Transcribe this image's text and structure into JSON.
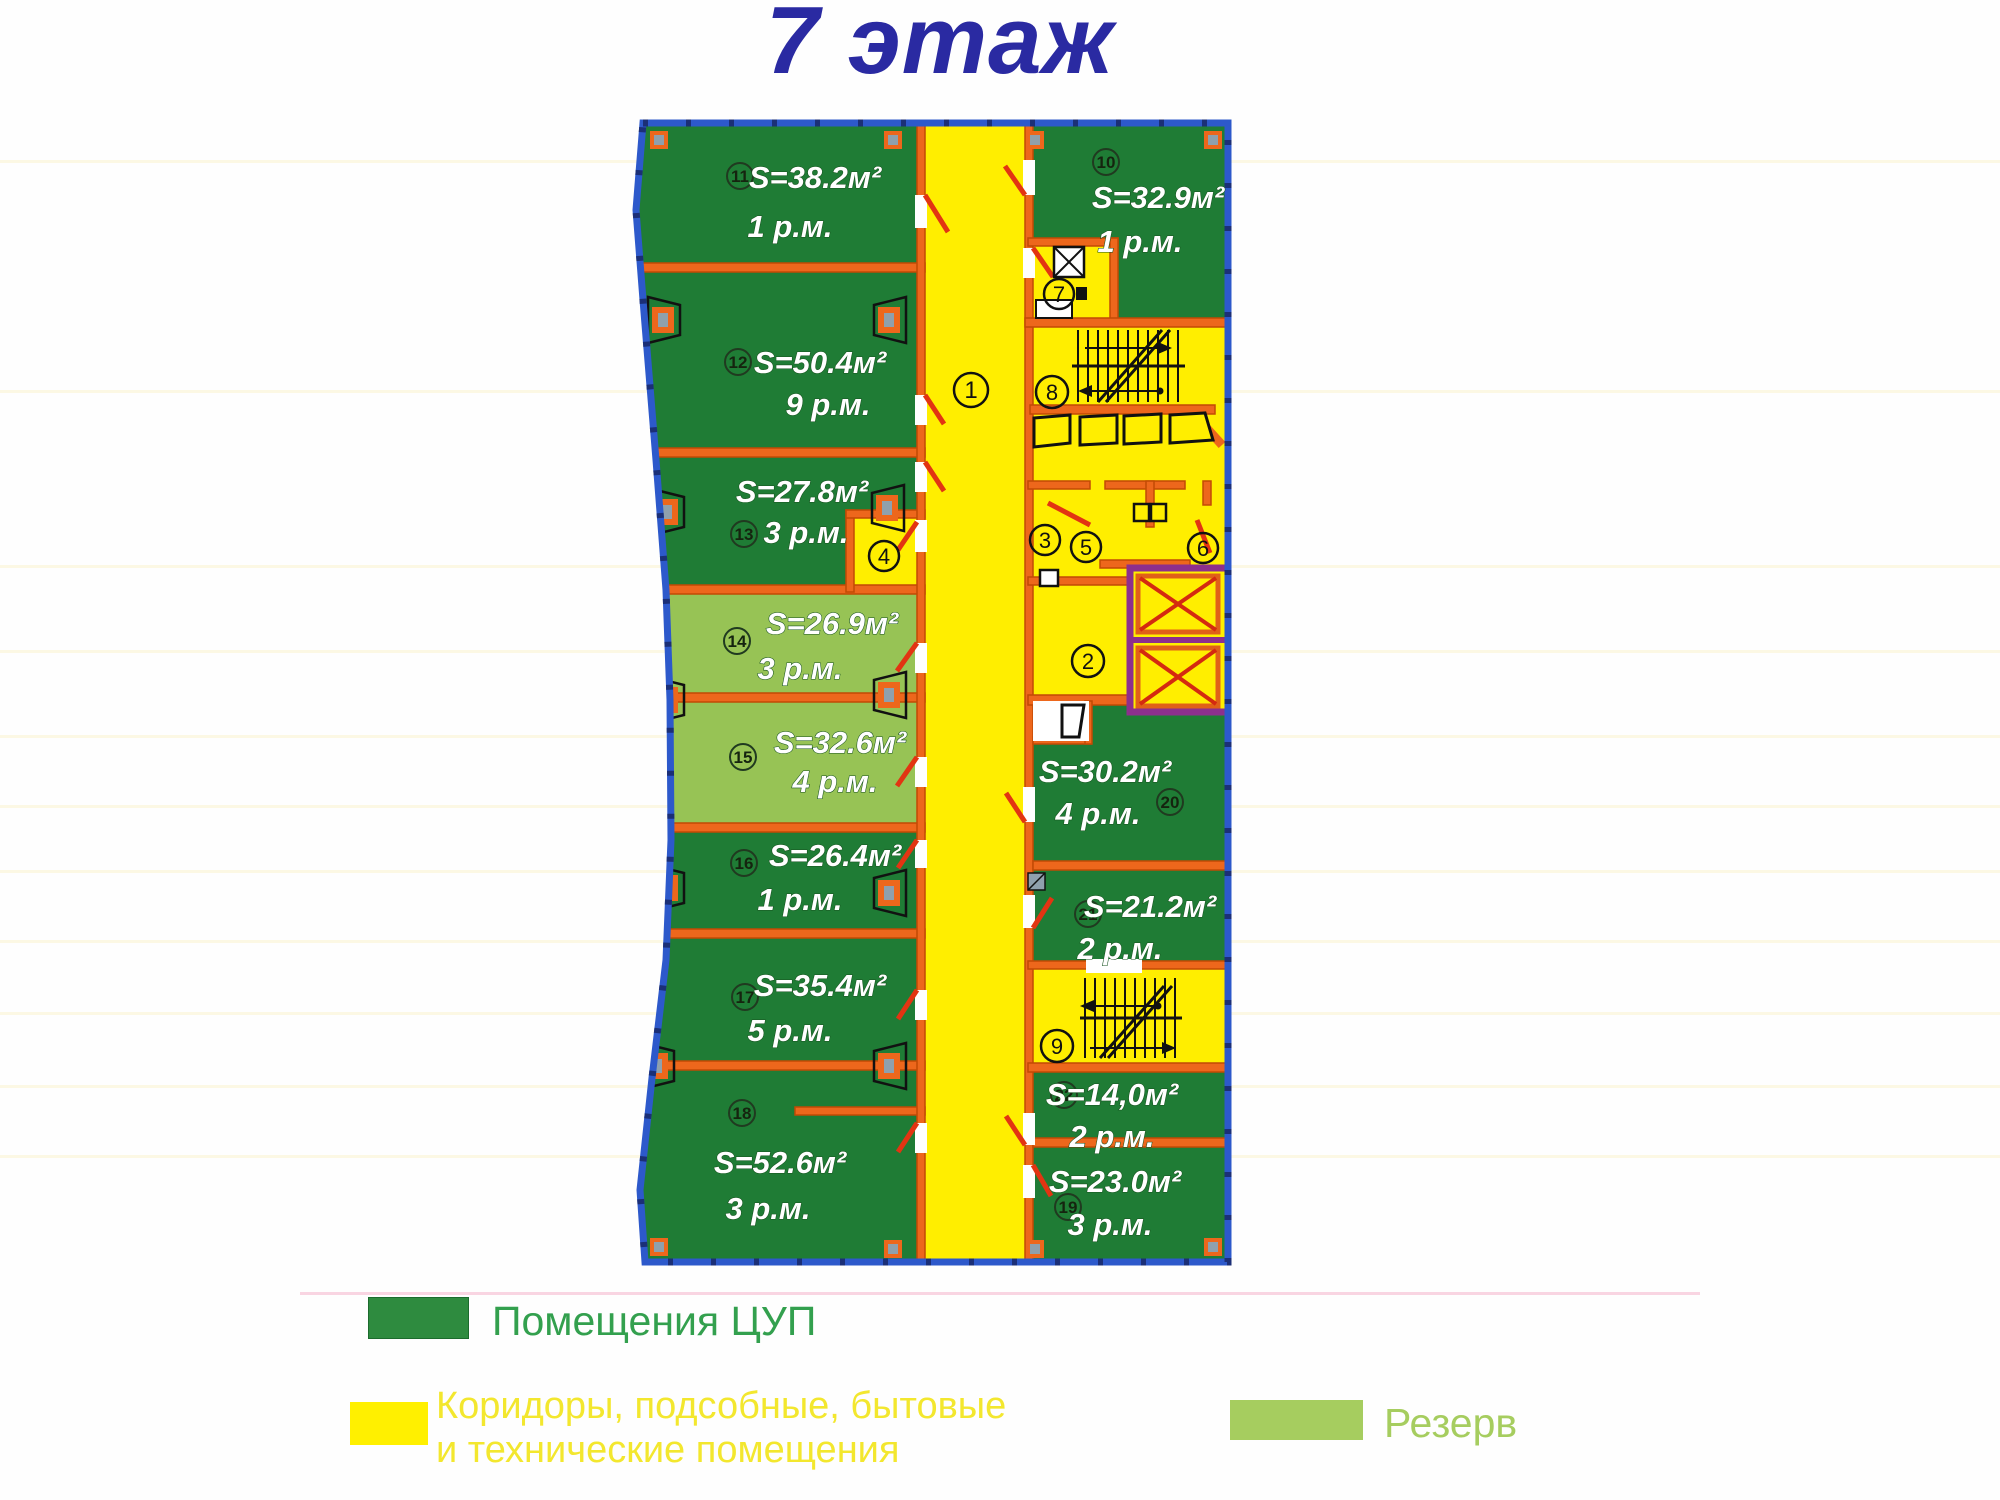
{
  "title": "7 этаж",
  "rooms": [
    {
      "num": "11",
      "area": "S=38.2м²",
      "spots": "1 р.м.",
      "reserve": false
    },
    {
      "num": "12",
      "area": "S=50.4м²",
      "spots": "9 р.м.",
      "reserve": false
    },
    {
      "num": "13",
      "area": "S=27.8м²",
      "spots": "3 р.м.",
      "reserve": false
    },
    {
      "num": "14",
      "area": "S=26.9м²",
      "spots": "3 р.м.",
      "reserve": true
    },
    {
      "num": "15",
      "area": "S=32.6м²",
      "spots": "4 р.м.",
      "reserve": true
    },
    {
      "num": "16",
      "area": "S=26.4м²",
      "spots": "1 р.м.",
      "reserve": false
    },
    {
      "num": "17",
      "area": "S=35.4м²",
      "spots": "5 р.м.",
      "reserve": false
    },
    {
      "num": "18",
      "area": "S=52.6м²",
      "spots": "3 р.м.",
      "reserve": false
    },
    {
      "num": "10",
      "area": "S=32.9м²",
      "spots": "1 р.м.",
      "reserve": false
    },
    {
      "num": "20",
      "area": "S=30.2м²",
      "spots": "4 р.м.",
      "reserve": false
    },
    {
      "num": "21",
      "area": "S=21.2м²",
      "spots": "2 р.м.",
      "reserve": false
    },
    {
      "num": "22",
      "area": "S=14,0м²",
      "spots": "2 р.м.",
      "reserve": false
    },
    {
      "num": "19",
      "area": "S=23.0м²",
      "spots": "3 р.м.",
      "reserve": false
    }
  ],
  "zones": [
    "1",
    "2",
    "3",
    "4",
    "5",
    "6",
    "7",
    "8",
    "9"
  ],
  "legend": [
    {
      "label": "Помещения ЦУП",
      "color": "#2e8b3f"
    },
    {
      "label": "Коридоры, подсобные, бытовые и технические помещения",
      "lines": [
        "Коридоры, подсобные, бытовые",
        "и технические помещения"
      ],
      "color": "#fff000"
    },
    {
      "label": "Резерв",
      "color": "#a6cd5f"
    }
  ],
  "colors": {
    "room_green": "#1f7c35",
    "reserve_green": "#97c355",
    "corridor_yellow": "#ffee00",
    "wall_orange": "#ed671c",
    "door_red": "#e23412",
    "elevator_purple": "#8d2f8d",
    "border_blue": "#2d59cb",
    "title_blue": "#2a2aa2",
    "legend_green_text": "#33a04e",
    "legend_yellow_text": "#f3e72e",
    "legend_reserve_text": "#a6cd5f"
  }
}
